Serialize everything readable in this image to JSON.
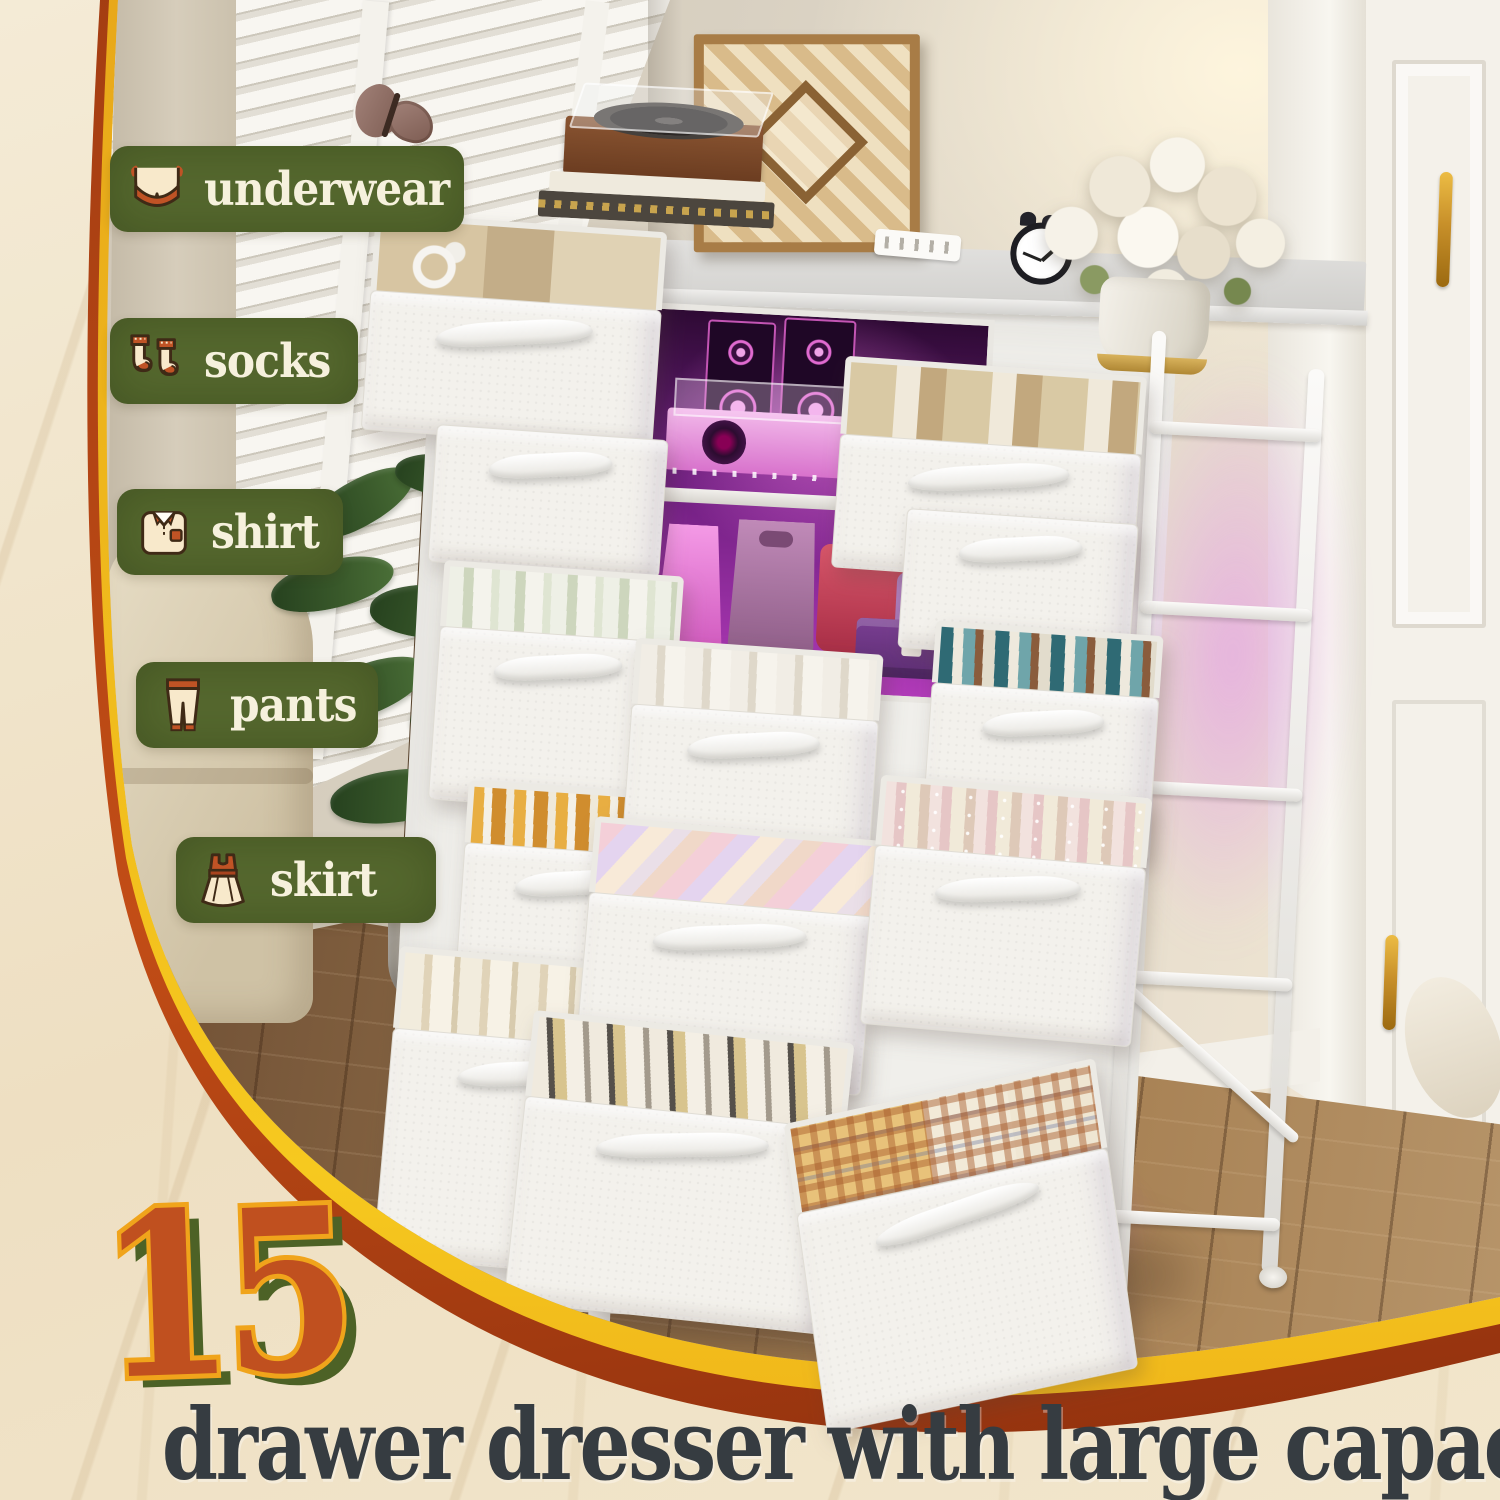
{
  "badges": [
    {
      "label": "underwear",
      "icon": "bra-icon"
    },
    {
      "label": "socks",
      "icon": "socks-icon"
    },
    {
      "label": "shirt",
      "icon": "shirt-icon"
    },
    {
      "label": "pants",
      "icon": "pants-icon"
    },
    {
      "label": "skirt",
      "icon": "dress-icon"
    }
  ],
  "headline": {
    "number": "15",
    "caption": "drawer dresser with large capacity"
  },
  "colors": {
    "badge_green": "#55682e",
    "badge_text": "#f6f1dd",
    "number_fill": "#c0501f",
    "number_outline": "#f0a41b",
    "number_shadow": "#4d6226",
    "caption_text": "#363c41",
    "frame_orange": "#a83d14",
    "frame_gold": "#f2b31c",
    "led_pink": "#df66d2",
    "marble_cream": "#f0e4cb"
  }
}
